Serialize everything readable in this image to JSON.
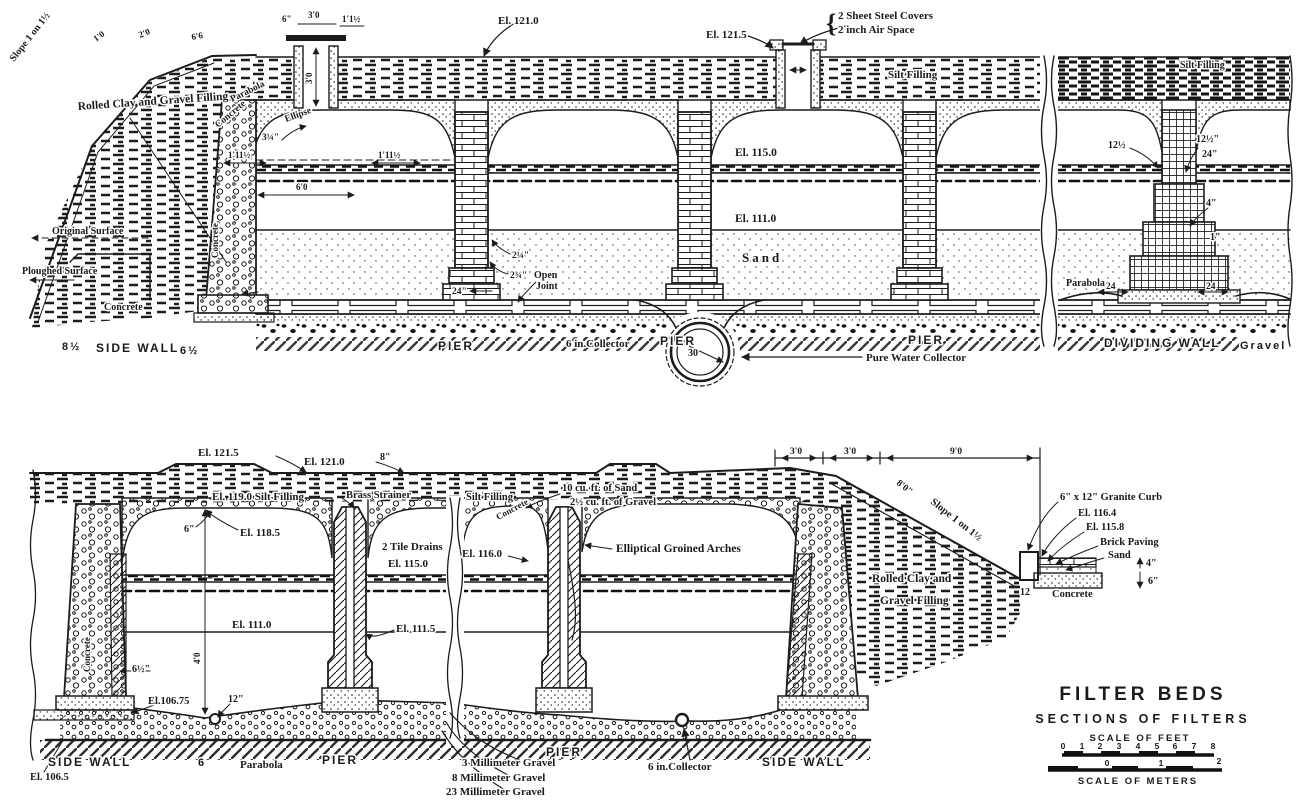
{
  "labels": {
    "top": {
      "slope": "Slope 1 on 1½",
      "rolled_clay": "Rolled Clay and Gravel Filling",
      "parabola": "Parabola",
      "concrete_diag": "Concrete",
      "ellipse": "Ellipse",
      "dim_3q": "3¼\"",
      "dim_1_11_l": "1'11½",
      "dim_1_11_r": "1'11½",
      "dim_6_0": "6'0",
      "dim_1_0": "1'0",
      "dim_2_0": "2'0",
      "dim_6_6": "6'6",
      "dim_6in": "6\"",
      "dim_3_0": "3'0",
      "dim_1_1h": "1'1½",
      "dim_3_0_v": "3'0",
      "original_surface": "Original Surface",
      "ploughed_surface": "Ploughed Surface",
      "concrete_wall": "Concrete",
      "el_121_0": "El. 121.0",
      "el_121_5": "El. 121.5",
      "covers_1": "2 Sheet Steel Covers",
      "covers_2": "2 inch Air Space",
      "silt_filling": "Silt Filling",
      "silt_filling_r": "Silt Filling",
      "el_115_0": "El. 115.0",
      "el_111_0": "El. 111.0",
      "sand": "Sand",
      "dim_2q": "2¼\"",
      "dim_2t": "2¾\"",
      "open_joint_1": "Open",
      "open_joint_2": "Joint",
      "dim_24in": "24\"",
      "concrete_footing": "Concrete",
      "dim_8h": "8½",
      "side_wall": "SIDE WALL",
      "dim_6h": "6½",
      "pier_1": "PIER",
      "pier_2": "PIER",
      "pier_3": "PIER",
      "collector_6in": "6 in.Collector",
      "dim_30": "30",
      "pure_water_collector": "Pure Water Collector",
      "dim_12h_l": "12½",
      "dim_12h_r": "12½\"",
      "dim_24_r": "24\"",
      "dim_4_r": "4\"",
      "dim_1_r": "1\"",
      "parabola_r": "Parabola",
      "dim_24_a": "24",
      "dim_24_b": "24",
      "dividing_wall": "DIVIDING WALL",
      "gravel": "Gravel"
    },
    "bottom": {
      "el_121_5": "El. 121.5",
      "el_121_0": "El. 121.0",
      "dim_8in": "8\"",
      "el_119_silt": "El. 119.0 Silt Filling",
      "brass_strainer": "Brass Strainer",
      "dim_6in": "6\"",
      "el_118_5": "El. 118.5",
      "tile_drains": "2 Tile Drains",
      "el_115_0": "El. 115.0",
      "el_111_0": "El. 111.0",
      "el_111_5": "El. 111.5",
      "concrete_wall": "Concrete",
      "dim_6h": "6½\"",
      "el_106_75": "El.106.75",
      "dim_12in": "12\"",
      "side_wall_l": "SIDE WALL",
      "el_106_5": "El. 106.5",
      "dim_6": "6",
      "parabola": "Parabola",
      "pier_l": "PIER",
      "dim_4_0": "4'0",
      "silt_filling": "Silt Filling",
      "sand_cuft": "10 cu. ft. of Sand",
      "gravel_cuft": "2½ cu. ft. of Gravel",
      "concrete_diag": "Concrete",
      "el_116_0": "El. 116.0",
      "groined": "Elliptical Groined Arches",
      "pier_m": "PIER",
      "gravel_3": "3 Millimeter Gravel",
      "gravel_8": "8 Millimeter Gravel",
      "gravel_23": "23 Millimeter Gravel",
      "collector_6in": "6 in.Collector",
      "side_wall_m": "SIDE WALL",
      "dim_3_0_a": "3'0",
      "dim_3_0_b": "3'0",
      "dim_9_0": "9'0",
      "dim_8_0": "8'0\"",
      "slope": "Slope 1 on 1½",
      "rolled_clay_1": "Rolled Clay and",
      "rolled_clay_2": "Gravel Filling",
      "granite_curb": "6\" x 12\" Granite Curb",
      "el_116_4": "El. 116.4",
      "el_115_8": "El. 115.8",
      "brick_paving": "Brick Paving",
      "sand": "Sand",
      "dim_4in": "4\"",
      "dim_6in_r": "6\"",
      "dim_12": "12",
      "concrete": "Concrete"
    }
  },
  "title_block": {
    "title": "FILTER BEDS",
    "subtitle": "SECTIONS OF FILTERS",
    "scale_feet": "SCALE OF FEET",
    "feet_ticks": [
      "0",
      "1",
      "2",
      "3",
      "4",
      "5",
      "6",
      "7",
      "8"
    ],
    "scale_meters": "SCALE OF METERS",
    "meter_ticks": [
      "0",
      "1",
      "2"
    ]
  }
}
